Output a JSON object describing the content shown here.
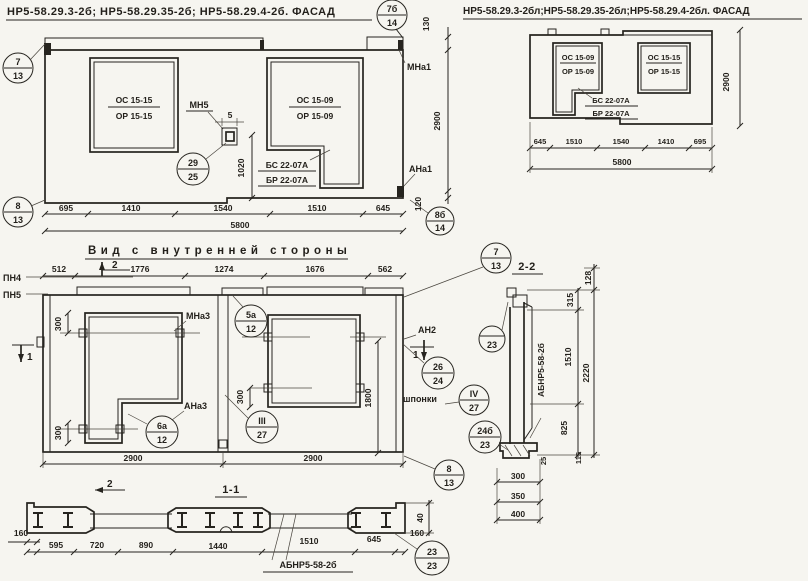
{
  "fl": {
    "title": "НР5-58.29.3-2б; НР5-58.29.35-2б; НР5-58.29.4-2б. ФАСАД",
    "win1a": "ОС 15-15",
    "win1b": "ОР 15-15",
    "win2a": "ОС 15-09",
    "win2b": "ОР 15-09",
    "bs": "БС 22-07А",
    "br": "БР 22-07А",
    "mn5": "МН5",
    "mna1": "МНа1",
    "ana1": "АНа1",
    "c7a": "7",
    "c7b": "13",
    "c7ba": "7б",
    "c7bb": "14",
    "c29a": "29",
    "c29b": "25",
    "c8a": "8",
    "c8b": "13",
    "c8ba": "8б",
    "c8bb": "14",
    "d130": "130",
    "d5": "5",
    "d1020": "1020",
    "d2900": "2900",
    "d120": "120",
    "dims": [
      "695",
      "1410",
      "1540",
      "1510",
      "645"
    ],
    "total": "5800"
  },
  "fr": {
    "title": "НР5-58.29.3-2бл;НР5-58.29.35-2бл;НР5-58.29.4-2бл. ФАСАД",
    "win1a": "ОС 15-09",
    "win1b": "ОР 15-09",
    "win2a": "ОС 15-15",
    "win2b": "ОР 15-15",
    "bs": "БС 22-07А",
    "br": "БР 22-07А",
    "d2900": "2900",
    "dims": [
      "645",
      "1510",
      "1540",
      "1410",
      "695"
    ],
    "total": "5800"
  },
  "iv": {
    "title": "Вид с внутренней стороны",
    "pn4": "ПН4",
    "pn5": "ПН5",
    "mna3": "МНа3",
    "ana3": "АНа3",
    "an2": "АН2",
    "shp": "шпонки",
    "m1": "1",
    "m2": "2",
    "c5aa": "5а",
    "c5ab": "12",
    "c6aa": "6а",
    "c6ab": "12",
    "c3a": "III",
    "c3b": "27",
    "c26a": "26",
    "c26b": "24",
    "c4a": "IV",
    "c4b": "27",
    "c7a": "7",
    "c7b": "13",
    "c8a": "8",
    "c8b": "13",
    "dtop": [
      "512",
      "1776",
      "1274",
      "1676",
      "562"
    ],
    "d300": "300",
    "d1800": "1800",
    "dbot": [
      "2900",
      "2900"
    ]
  },
  "s2": {
    "title": "2-2",
    "lbl": "АБНР5-58-2б",
    "c23": "23",
    "c24a": "24б",
    "c24b": "23",
    "d128": "128",
    "d315": "315",
    "d1510": "1510",
    "d2220": "2220",
    "d825": "825",
    "d25": "25",
    "d115": "115",
    "d300": "300",
    "d350": "350",
    "d400": "400"
  },
  "s1": {
    "title": "1-1",
    "lbl": "АБНР5-58-2б",
    "c23a": "23",
    "c23b": "23",
    "l160": "160",
    "r160": "160",
    "d40": "40",
    "dims": [
      "595",
      "720",
      "890",
      "1440",
      "1510",
      "645"
    ]
  }
}
